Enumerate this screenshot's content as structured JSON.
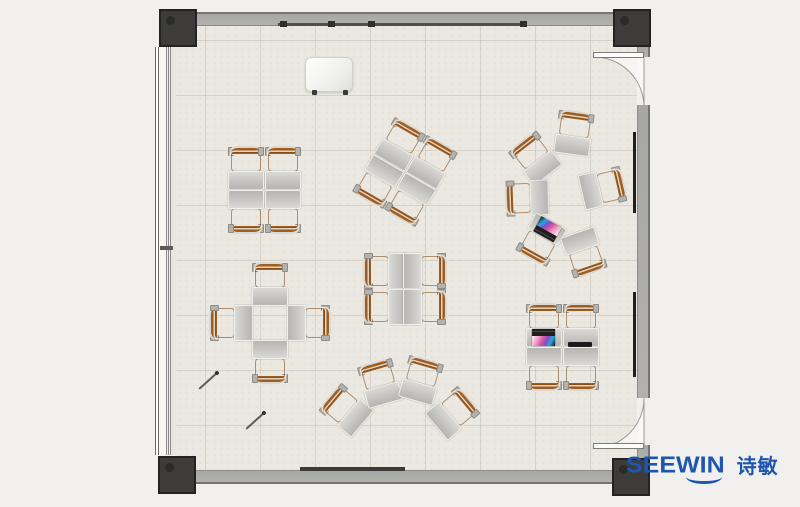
{
  "brand": {
    "name": "SEEWIN",
    "cjk": "诗敏",
    "color": "#1e55ae"
  },
  "palette": {
    "floor": "#eae8e0",
    "wall": "#a8a8a6",
    "corner_post": "#3d3c3b",
    "chair_orange": "#c57a31",
    "desk_gray": "#c6c5c1",
    "outside": "#f1f0ee"
  },
  "scene": {
    "label": "classroom-floor-plan-top-view",
    "fixtures": [
      "window-wall-left",
      "door-top-right",
      "door-bottom-right",
      "whiteboard-rail-top",
      "whiteboard-rail-bottom",
      "wall-boards-right",
      "podium",
      "pens-on-floor"
    ]
  },
  "furniture": {
    "unit_width": 36,
    "unit_height": 44,
    "clusters": [
      {
        "id": "quad-top-left",
        "units": [
          {
            "cx": 246,
            "cy": 168,
            "rot": 0
          },
          {
            "cx": 283,
            "cy": 168,
            "rot": 0
          },
          {
            "cx": 246,
            "cy": 212,
            "rot": 180
          },
          {
            "cx": 283,
            "cy": 212,
            "rot": 180
          }
        ]
      },
      {
        "id": "quad-rotated",
        "units": [
          {
            "cx": 400,
            "cy": 144,
            "rot": 30
          },
          {
            "cx": 432,
            "cy": 162,
            "rot": 30
          },
          {
            "cx": 378,
            "cy": 182,
            "rot": 210
          },
          {
            "cx": 410,
            "cy": 200,
            "rot": 210
          }
        ]
      },
      {
        "id": "circle-right",
        "units": [
          {
            "cx": 574,
            "cy": 133,
            "rot": 8
          },
          {
            "cx": 535,
            "cy": 158,
            "rot": -38
          },
          {
            "cx": 527,
            "cy": 198,
            "rot": -92
          },
          {
            "cx": 541,
            "cy": 240,
            "rot": -151,
            "accessory": "laptop-open"
          },
          {
            "cx": 584,
            "cy": 253,
            "rot": 161
          },
          {
            "cx": 603,
            "cy": 188,
            "rot": 77
          }
        ]
      },
      {
        "id": "plus-left",
        "units": [
          {
            "cx": 270,
            "cy": 284,
            "rot": 0
          },
          {
            "cx": 231,
            "cy": 323,
            "rot": -90
          },
          {
            "cx": 309,
            "cy": 323,
            "rot": 90
          },
          {
            "cx": 270,
            "cy": 362,
            "rot": 180
          }
        ]
      },
      {
        "id": "quad-center",
        "units": [
          {
            "cx": 385,
            "cy": 271,
            "rot": -90
          },
          {
            "cx": 385,
            "cy": 307,
            "rot": -90
          },
          {
            "cx": 425,
            "cy": 271,
            "rot": 90
          },
          {
            "cx": 425,
            "cy": 307,
            "rot": 90
          }
        ]
      },
      {
        "id": "fan-bottom",
        "units": [
          {
            "cx": 346,
            "cy": 410,
            "rot": -50
          },
          {
            "cx": 380,
            "cy": 383,
            "rot": -16
          },
          {
            "cx": 421,
            "cy": 380,
            "rot": 16
          },
          {
            "cx": 453,
            "cy": 413,
            "rot": 50
          }
        ]
      },
      {
        "id": "quad-bottom-right",
        "units": [
          {
            "cx": 544,
            "cy": 325,
            "rot": 0,
            "accessory": "laptop-open"
          },
          {
            "cx": 581,
            "cy": 325,
            "rot": 0,
            "accessory": "laptop-closed"
          },
          {
            "cx": 544,
            "cy": 369,
            "rot": 180
          },
          {
            "cx": 581,
            "cy": 369,
            "rot": 180
          }
        ]
      }
    ]
  }
}
